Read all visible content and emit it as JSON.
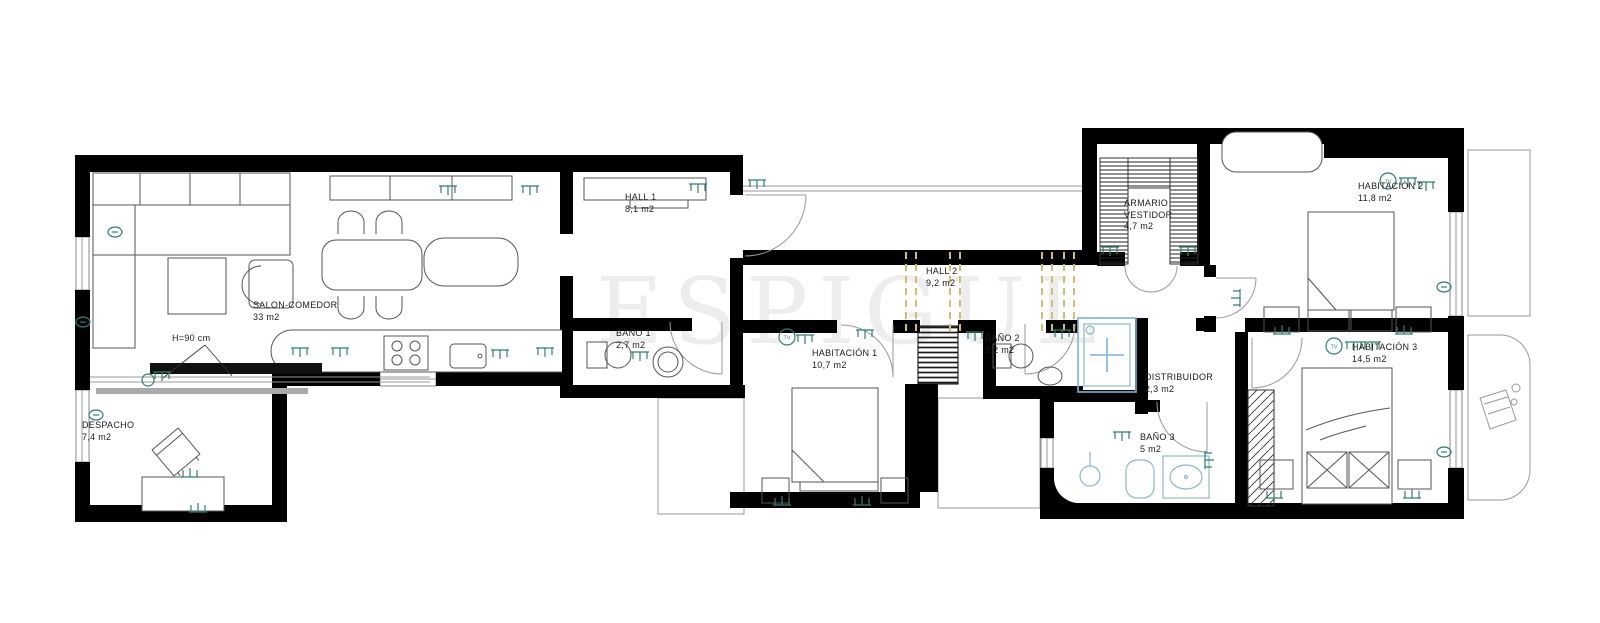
{
  "watermark": {
    "text": "ESPIGUL"
  },
  "annotations": {
    "h90": "H=90 cm"
  },
  "icons": {
    "tv_label": "TV",
    "outlet": "outlet-icon",
    "wall_lamp": "wall-lamp-icon"
  },
  "colors": {
    "wall": "#000000",
    "furniture": "#555555",
    "outlet_teal": "#2e7f72",
    "beam_dashed": "#cfc06e",
    "shower_blue": "#7fb2d6",
    "bath_fixture": "#8bb9c9",
    "watermark_gray": "#ededed"
  },
  "rooms": [
    {
      "id": "salon-comedor",
      "name": "SALON-COMEDOR",
      "area": "33 m2"
    },
    {
      "id": "despacho",
      "name": "DESPACHO",
      "area": "7,4 m2"
    },
    {
      "id": "hall-1",
      "name": "HALL 1",
      "area": "8,1 m2"
    },
    {
      "id": "bano-1",
      "name": "BAÑO 1",
      "area": "2,7 m2"
    },
    {
      "id": "hall-2",
      "name": "HALL 2",
      "area": "9,2 m2"
    },
    {
      "id": "habitacion-1",
      "name": "HABITACIÓN 1",
      "area": "10,7 m2"
    },
    {
      "id": "bano-2",
      "name": "BAÑO 2",
      "area": "3,2 m2"
    },
    {
      "id": "armario-vestidor",
      "name": "ARMARIO",
      "name2": "VESTIDOR",
      "area": "4,7 m2"
    },
    {
      "id": "habitacion-2",
      "name": "HABITACIÓN 2",
      "area": "11,8 m2"
    },
    {
      "id": "distribuidor",
      "name": "DISTRIBUIDOR",
      "area": "2,3 m2"
    },
    {
      "id": "bano-3",
      "name": "BAÑO 3",
      "area": "5 m2"
    },
    {
      "id": "habitacion-3",
      "name": "HABITACIÓN 3",
      "area": "14,5 m2"
    }
  ]
}
